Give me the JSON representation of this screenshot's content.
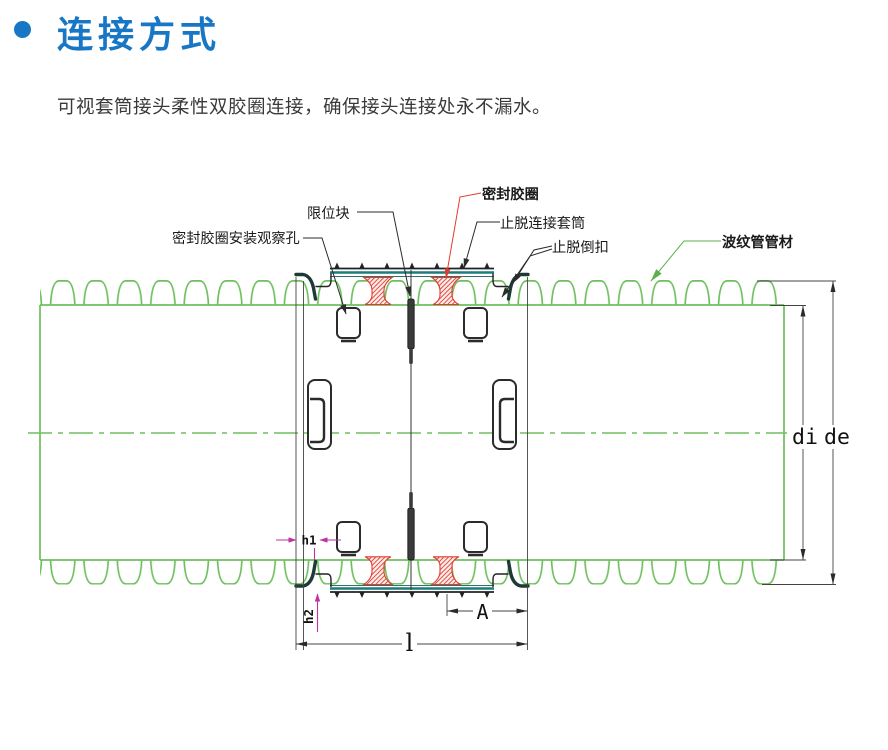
{
  "header": {
    "title": "连接方式",
    "description": "可视套筒接头柔性双胶圈连接，确保接头连接处永不漏水。"
  },
  "diagram": {
    "labels": {
      "observation_hole": "密封胶圈安装观察孔",
      "limit_block": "限位块",
      "seal_ring": "密封胶圈",
      "anti_pullout_sleeve": "止脱连接套筒",
      "anti_pullout_buckle": "止脱倒扣",
      "corrugated_pipe": "波纹管管材"
    },
    "dimensions": {
      "di": "di",
      "de": "de",
      "A": "A",
      "l": "l",
      "h1": "h1",
      "h2": "h2"
    },
    "colors": {
      "title_blue": "#1777C5",
      "pipe_green": "#6FBF5F",
      "sleeve_teal": "#1D7C7C",
      "seal_red": "#E23B2E",
      "dim_magenta": "#C032A0"
    }
  }
}
